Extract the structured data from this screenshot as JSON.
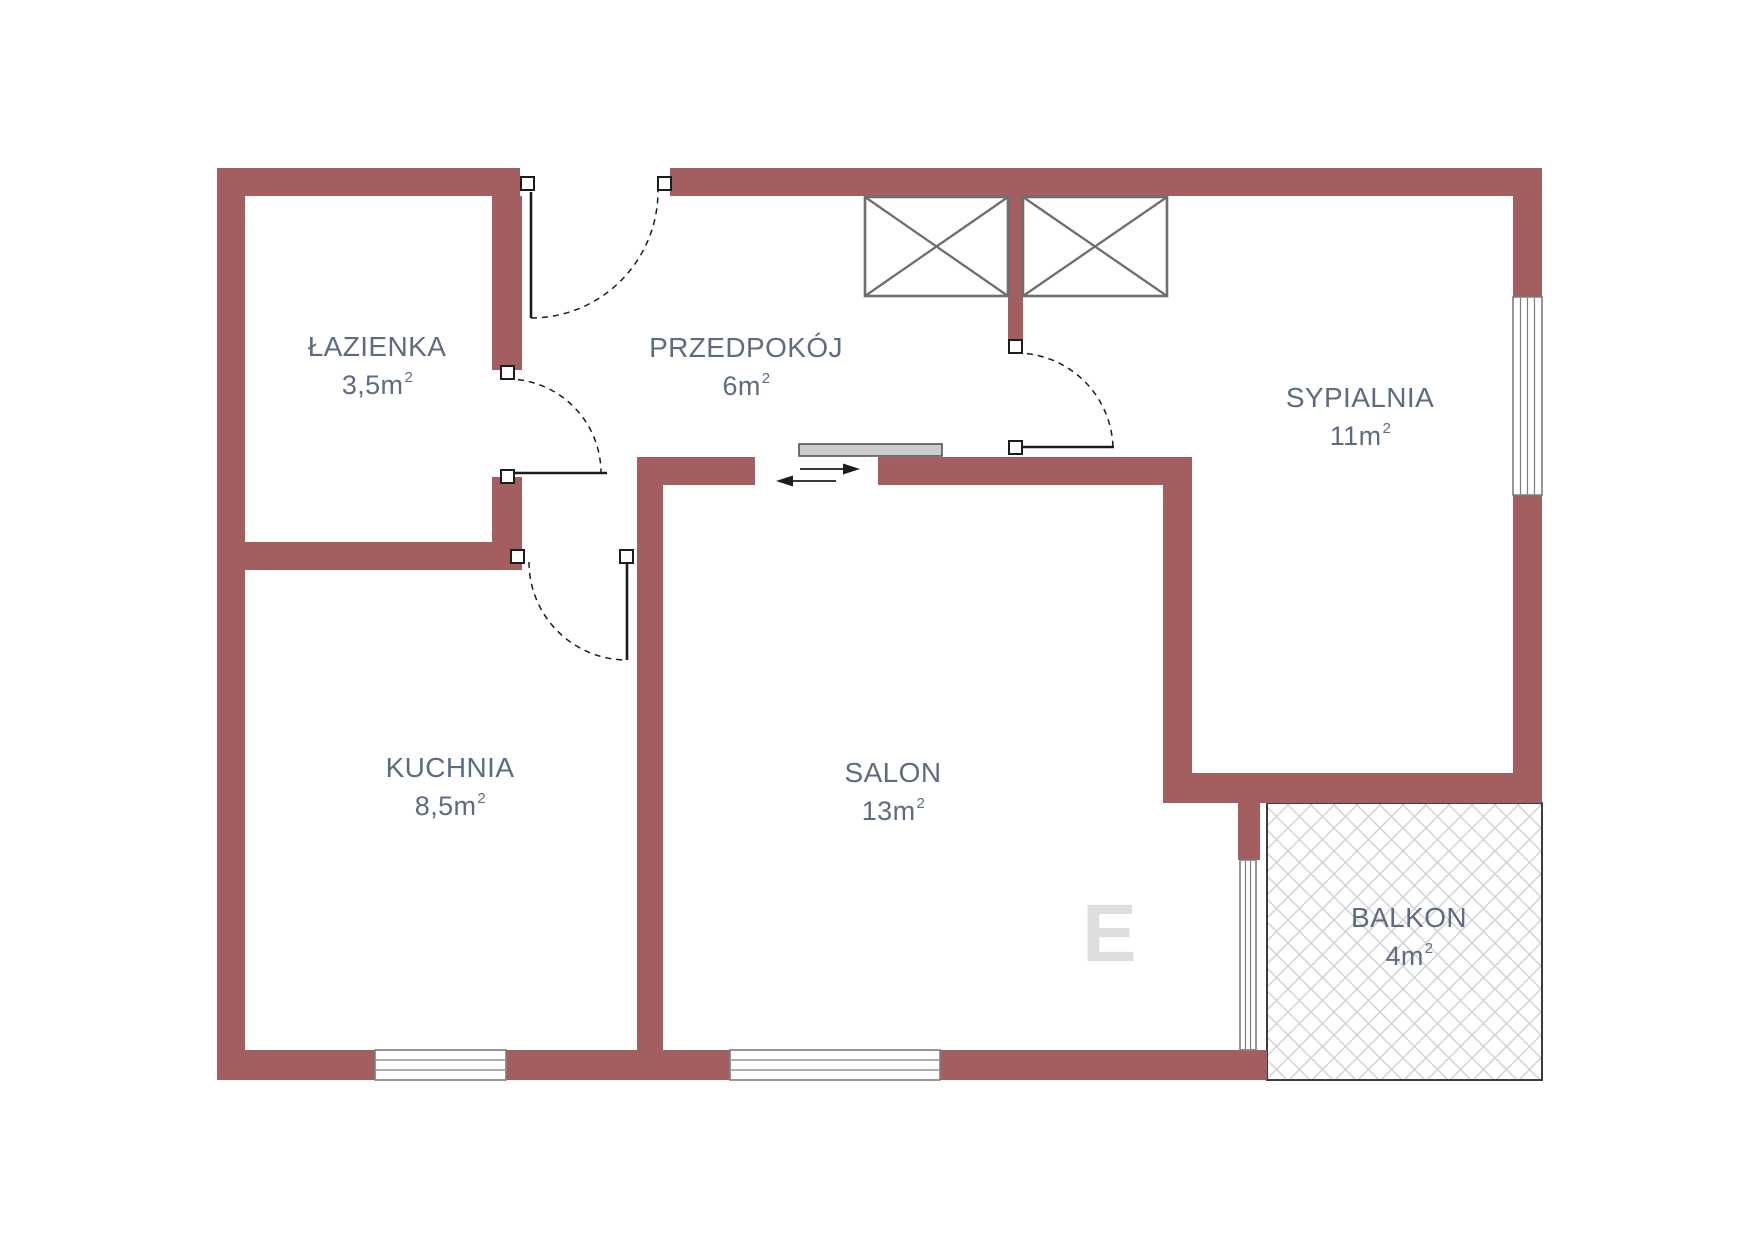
{
  "plan": {
    "colors": {
      "bg": "#ffffff",
      "wall": "#a35f60",
      "text": "#5d6c80",
      "line": "#1c1c1c",
      "window": "#7d7d7d",
      "furniture": "#6e6e6e",
      "slider": "#cccccc",
      "hatch": "#cdd2d5",
      "watermark": "#dedede"
    },
    "rooms": [
      {
        "id": "lazienka",
        "name": "ŁAZIENKA",
        "area": "3,5m",
        "sup": "2"
      },
      {
        "id": "przedpokoj",
        "name": "PRZEDPOKÓJ",
        "area": "6m",
        "sup": "2"
      },
      {
        "id": "sypialnia",
        "name": "SYPIALNIA",
        "area": "11m",
        "sup": "2"
      },
      {
        "id": "kuchnia",
        "name": "KUCHNIA",
        "area": "8,5m",
        "sup": "2"
      },
      {
        "id": "salon",
        "name": "SALON",
        "area": "13m",
        "sup": "2"
      },
      {
        "id": "balkon",
        "name": "BALKON",
        "area": "4m",
        "sup": "2"
      }
    ],
    "watermark": "E"
  }
}
